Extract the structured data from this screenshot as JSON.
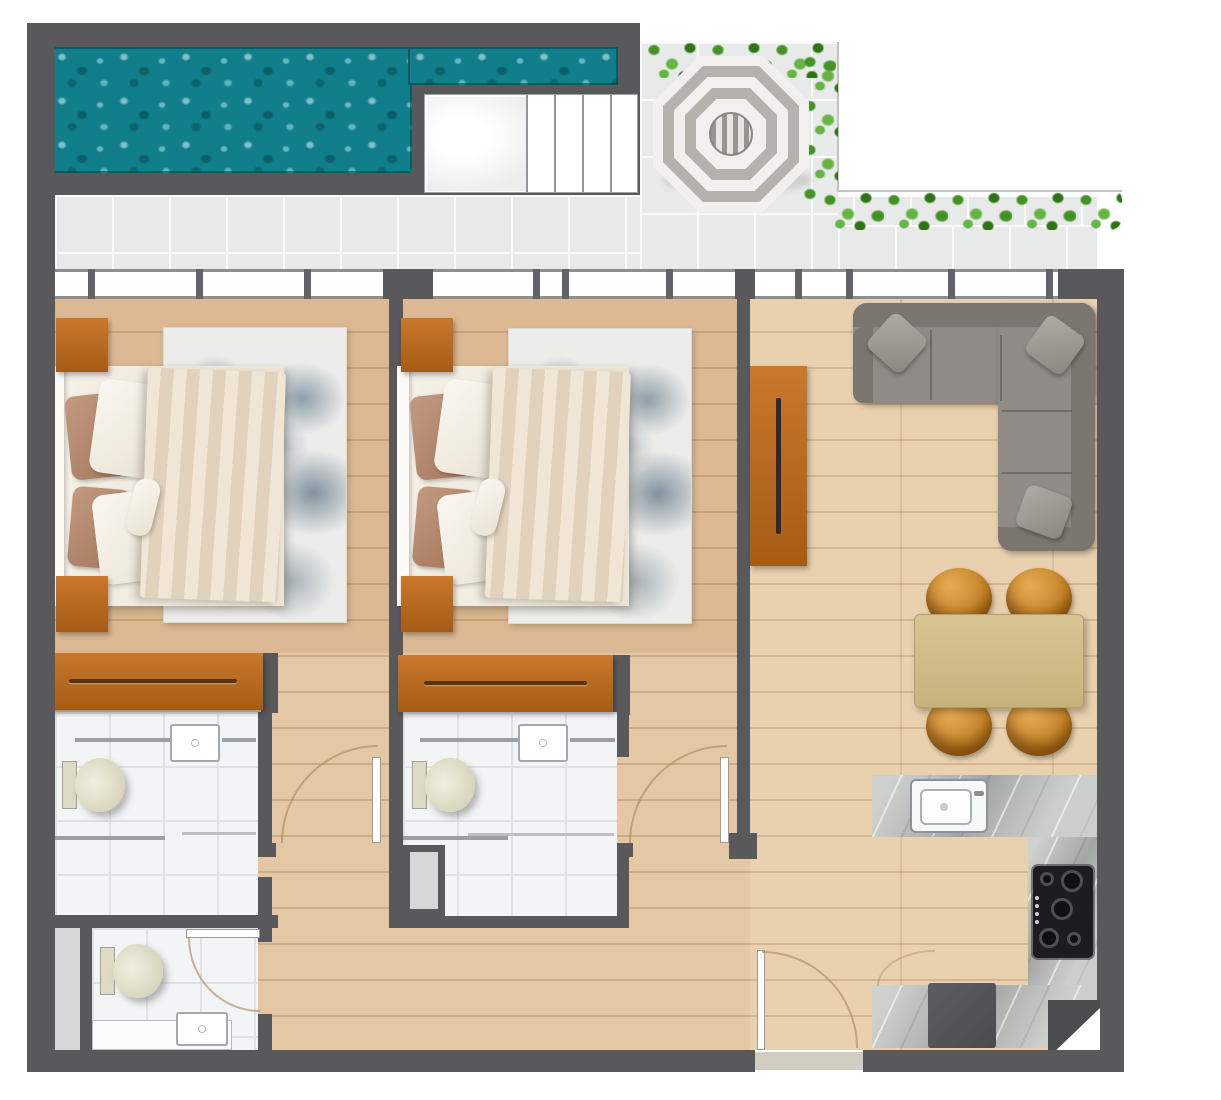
{
  "canvas": {
    "width": 1221,
    "height": 1100
  },
  "colors": {
    "wall": "#59595b",
    "wallDark": "#4c4c4e",
    "water": "#117e8b",
    "tile": "#e8e9e9",
    "tileLine": "#fafafa",
    "bathTile": "#f3f4f6",
    "bathLine": "#dfe2e5",
    "windowWhite": "#ffffff",
    "windowFrame": "#8a8f92",
    "floorBase": "#e4c8a4",
    "floorBedroom": "#dcb992",
    "floorLiving": "#e9d1af",
    "rugBase": "#ececea",
    "sofa": "#908b86",
    "sofaDark": "#7b766f",
    "counter": "#b6b9b7",
    "sink": "#f6f7f7",
    "toilet": "#e7e4cf",
    "hedgeDark": "#2c7515",
    "hedgeMid": "#459327",
    "hedgeLight": "#66b441",
    "umbrellaGray": "#b5b2ae",
    "umbrellaWhite": "#f1f0ee",
    "shaft": "#d7d7d7",
    "doorArc": "rgba(172,132,96,0.6)",
    "threshold": "#d3ccc3"
  },
  "scene": {
    "type": "apartment-floor-plan-top-view",
    "outdoor": [
      "swimming-pool",
      "pool-steps",
      "terrace-tiles",
      "striped-parasol",
      "hedge-planters"
    ],
    "rooms": [
      "bedroom-1",
      "bedroom-2",
      "living-dining-room",
      "kitchen",
      "bathroom-1",
      "bathroom-2",
      "bathroom-3",
      "hallway"
    ],
    "furniture": {
      "bedroom": [
        "double-bed",
        "area-rug",
        "nightstand-top",
        "nightstand-bottom",
        "dresser"
      ],
      "living": [
        "l-shaped-sofa",
        "throw-pillows",
        "tv-console",
        "dining-table",
        "dining-chairs-x4"
      ],
      "kitchen": [
        "kitchen-sink",
        "gas-cooktop",
        "countertop",
        "appliance-block",
        "corner-cabinet"
      ],
      "bathroom": [
        "toilet",
        "wash-basin",
        "shower-partition"
      ]
    },
    "doors": [
      "hall-door-left",
      "hall-door-right",
      "bathroom-3-door",
      "entry-door"
    ]
  }
}
